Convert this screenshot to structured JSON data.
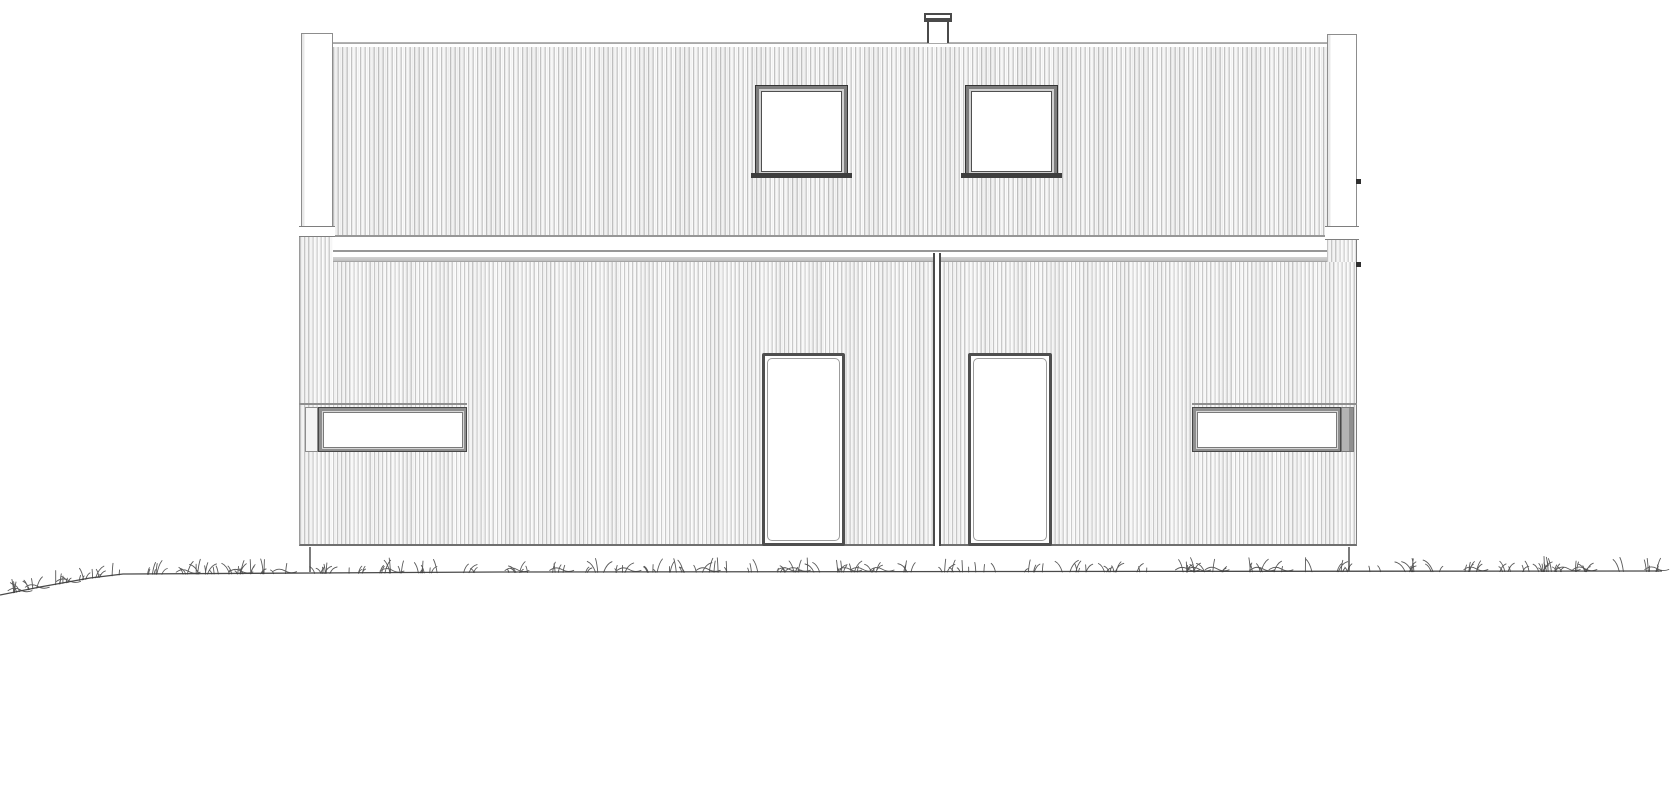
{
  "drawing": {
    "subject": "house-elevation-two-storey-duplex",
    "style": "black-and-white architectural line drawing, vertical timber cladding",
    "canvas": {
      "width": 1670,
      "height": 800
    },
    "colors": {
      "background": "#ffffff",
      "glass": "#ffffff",
      "frame_edge": "#333333",
      "siding_line": "#c2c2c2",
      "ground_line": "#4a4a4a",
      "grass": "#3d3d3d"
    },
    "elements": {
      "fascia": {
        "x": 333,
        "y": 42,
        "w": 994,
        "h": 2
      },
      "upper_wall": {
        "x": 333,
        "y": 47,
        "w": 994,
        "h": 188
      },
      "upper_line_a": {
        "x": 333,
        "y": 235,
        "w": 994,
        "h": 2.5
      },
      "band_white_a": {
        "x": 333,
        "y": 237,
        "w": 994,
        "h": 13
      },
      "upper_line_b": {
        "x": 333,
        "y": 250,
        "w": 994,
        "h": 2.5
      },
      "band_white_b": {
        "x": 333,
        "y": 252,
        "w": 994,
        "h": 5
      },
      "band_gray": {
        "x": 333,
        "y": 257,
        "w": 994,
        "h": 5
      },
      "lower_wall": {
        "x": 299,
        "y": 262,
        "w": 1058,
        "h": 284
      },
      "corner_strip_left": {
        "x": 299,
        "y": 237,
        "w": 34,
        "h": 25
      },
      "corner_strip_right": {
        "x": 1327,
        "y": 240,
        "w": 30,
        "h": 22
      },
      "left_post": {
        "x": 301,
        "y": 33,
        "w": 32,
        "h": 204
      },
      "left_post_cap": {
        "x": 299,
        "y": 226,
        "w": 36,
        "h": 11
      },
      "right_post": {
        "x": 1327,
        "y": 34,
        "w": 30,
        "h": 206
      },
      "right_post_cap": {
        "x": 1325,
        "y": 226,
        "w": 34,
        "h": 14
      },
      "divider": {
        "x": 933,
        "y": 253,
        "w": 8,
        "h": 293
      },
      "upper_window_1": {
        "x": 755,
        "y": 85,
        "w": 93,
        "h": 93
      },
      "upper_window_2": {
        "x": 965,
        "y": 85,
        "w": 93,
        "h": 93
      },
      "sill_1": {
        "x": 751,
        "y": 173,
        "w": 101,
        "h": 5
      },
      "sill_2": {
        "x": 961,
        "y": 173,
        "w": 101,
        "h": 5
      },
      "door_1": {
        "x": 762,
        "y": 353,
        "w": 83,
        "h": 193
      },
      "door_2": {
        "x": 968,
        "y": 353,
        "w": 84,
        "h": 193
      },
      "lower_window_1": {
        "x": 318,
        "y": 407,
        "w": 149,
        "h": 45
      },
      "lower_window_1_side": {
        "x": 305,
        "y": 407,
        "w": 13,
        "h": 45
      },
      "lower_window_1_head": {
        "x": 299,
        "y": 403,
        "w": 168,
        "h": 1.5
      },
      "lower_window_2": {
        "x": 1192,
        "y": 407,
        "w": 149,
        "h": 45
      },
      "lower_window_2_side": {
        "x": 1341,
        "y": 407,
        "w": 13,
        "h": 45
      },
      "lower_window_2_head": {
        "x": 1192,
        "y": 403,
        "w": 165,
        "h": 1.5
      },
      "chimney_cap": {
        "x": 924,
        "y": 13,
        "w": 28,
        "h": 9
      },
      "chimney_stack": {
        "x": 927,
        "y": 22,
        "w": 22,
        "h": 21
      },
      "tick_upper": {
        "x": 1356,
        "y": 179,
        "w": 5,
        "h": 5
      },
      "tick_lower": {
        "x": 1356,
        "y": 262,
        "w": 5,
        "h": 5
      },
      "foundation_left": {
        "x": 309,
        "y": 547,
        "w": 1.5,
        "h": 25
      },
      "foundation_right": {
        "x": 1348,
        "y": 547,
        "w": 1.5,
        "h": 24
      }
    },
    "ground": {
      "path": [
        [
          0,
          595
        ],
        [
          40,
          587
        ],
        [
          90,
          578
        ],
        [
          123,
          574
        ],
        [
          500,
          572
        ],
        [
          1000,
          571.5
        ],
        [
          1662,
          571
        ]
      ],
      "grass": {
        "x_start": 6,
        "x_end": 1652,
        "seed": 11,
        "blade_min": 4,
        "blade_max": 16
      }
    }
  }
}
